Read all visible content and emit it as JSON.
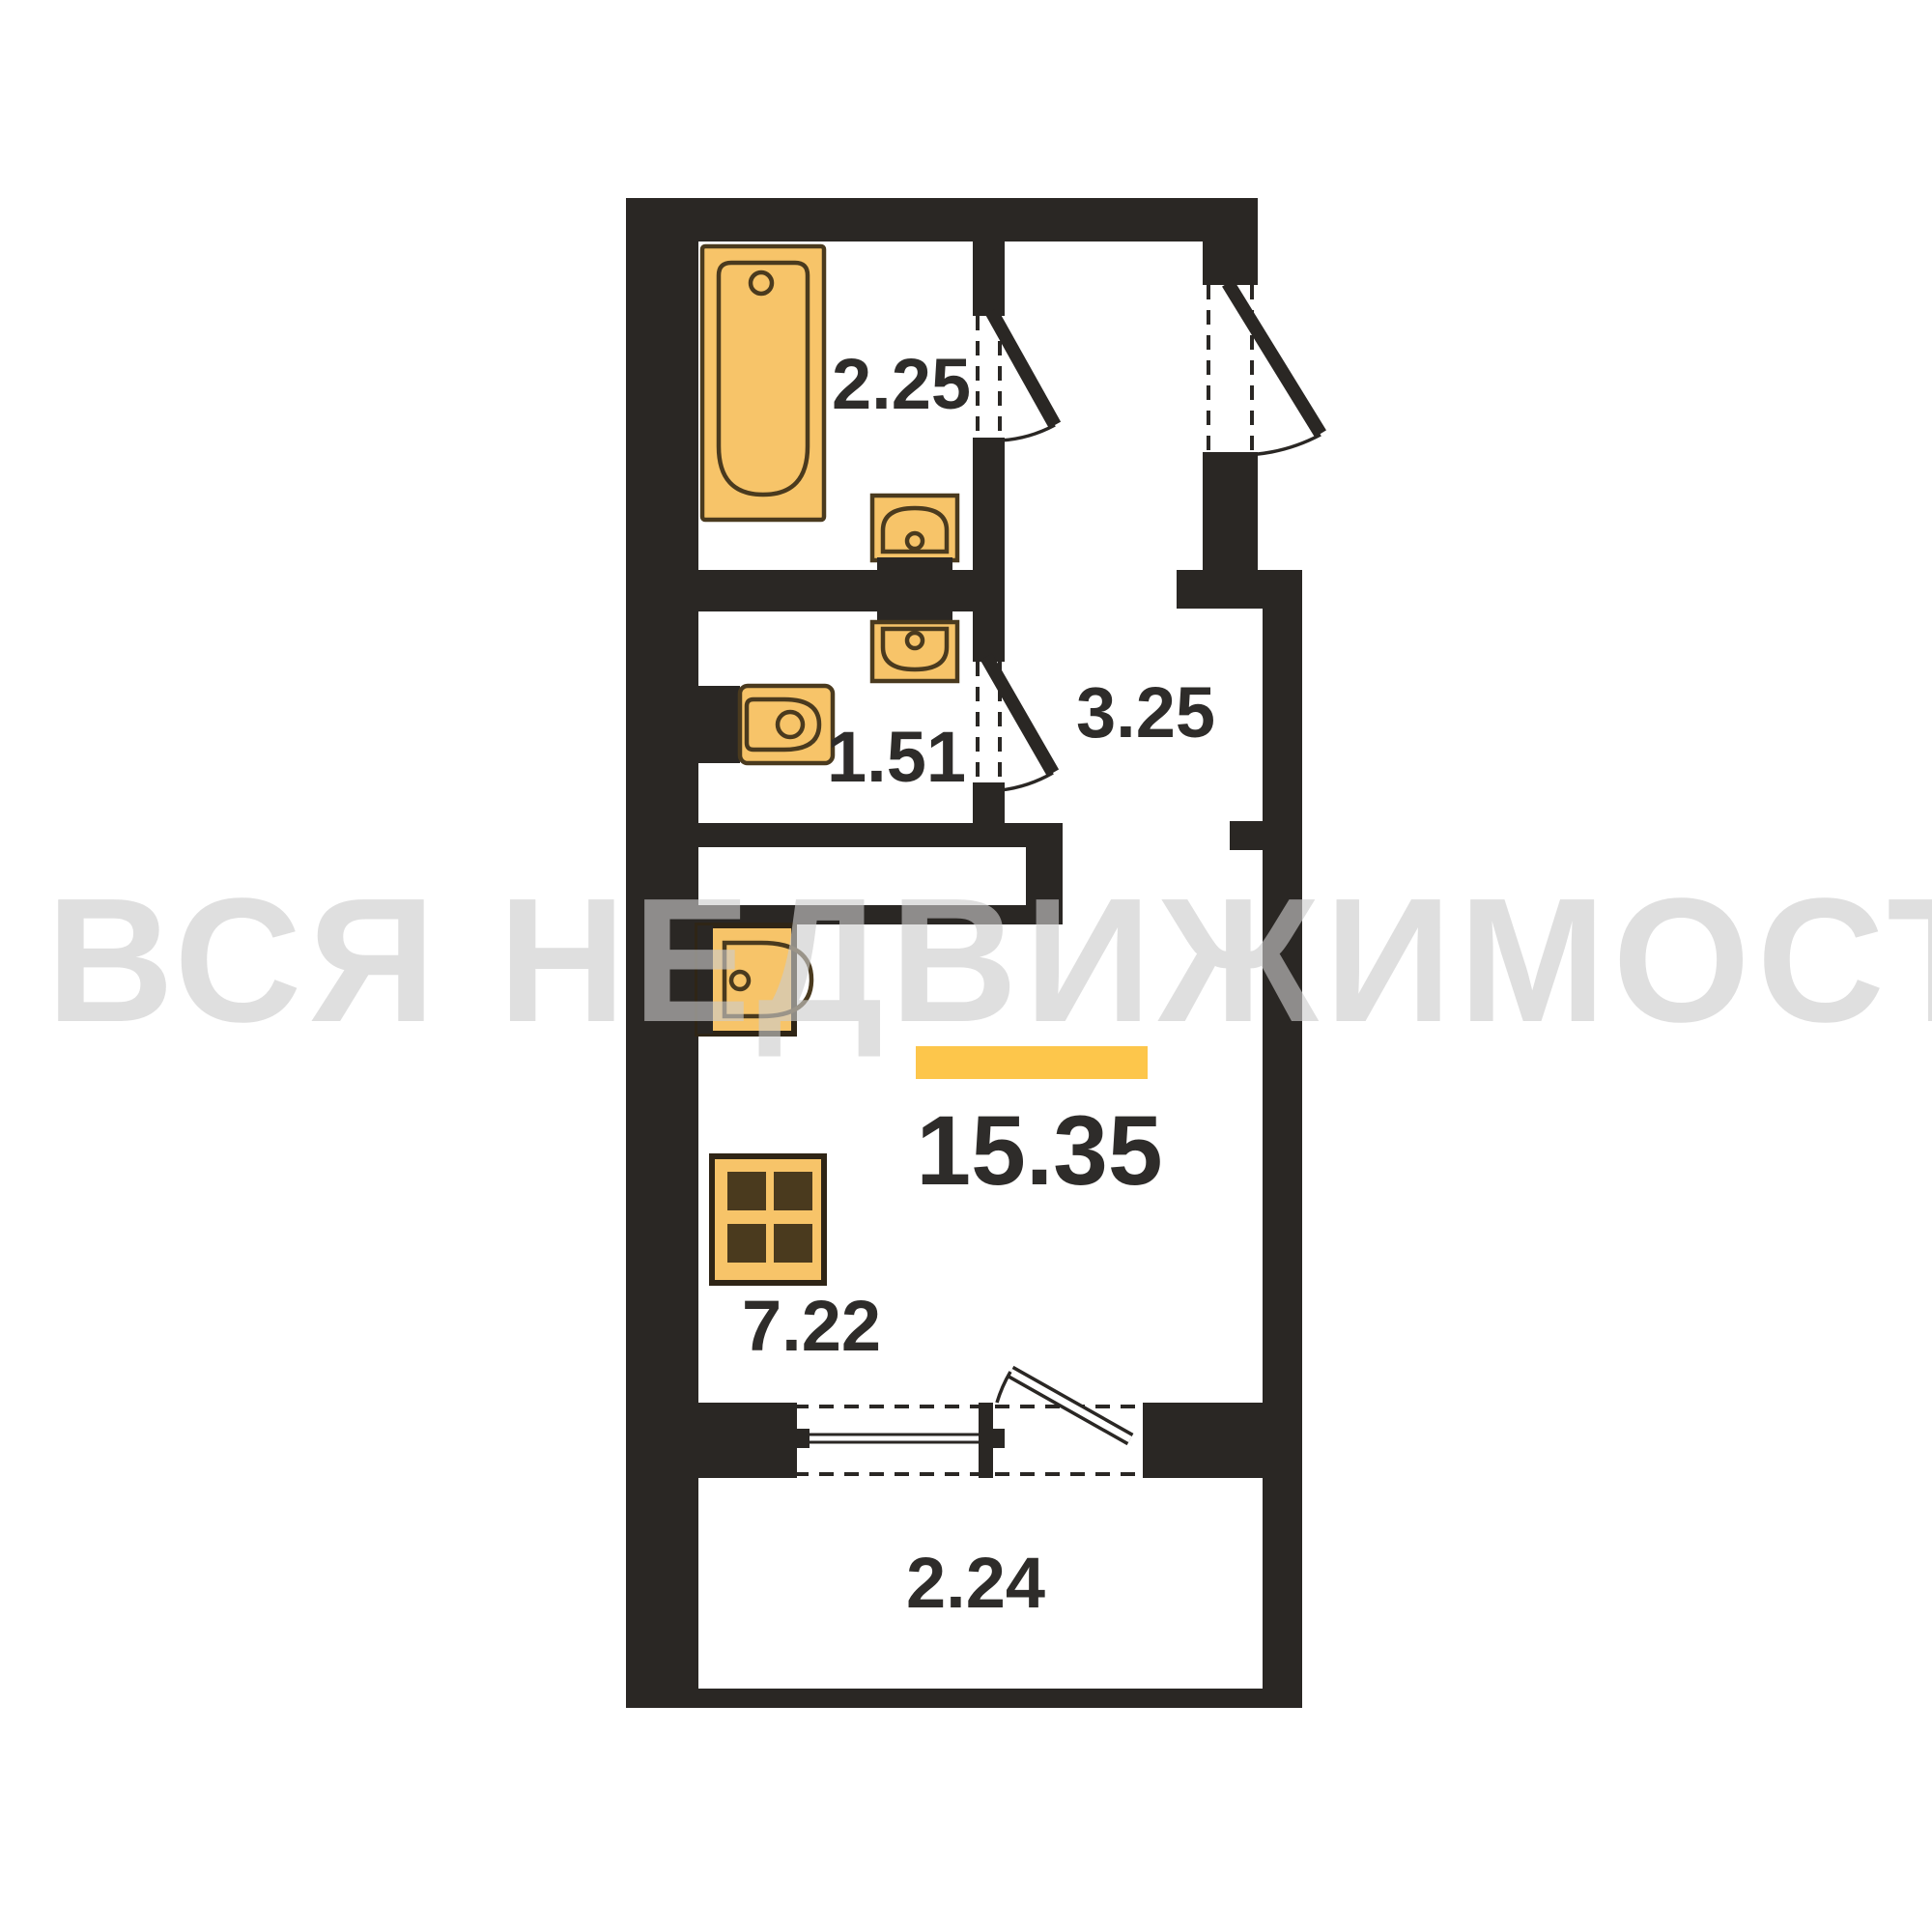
{
  "watermark": {
    "text": "ВСЯ НЕДВИЖИМОСТЬ"
  },
  "plan": {
    "title": "studio apartment floor plan",
    "rooms": [
      {
        "id": "bathroom",
        "area_label": "2.25"
      },
      {
        "id": "toilet",
        "area_label": "1.51"
      },
      {
        "id": "hallway",
        "area_label": "3.25"
      },
      {
        "id": "living-room",
        "area_label": "15.35"
      },
      {
        "id": "kitchen-zone",
        "area_label": "7.22"
      },
      {
        "id": "balcony",
        "area_label": "2.24"
      }
    ],
    "fixtures": [
      "bathtub",
      "bathroom-sink",
      "wc-sink",
      "toilet-bowl",
      "kitchen-sink",
      "stove",
      "wardrobe-highlight"
    ],
    "openings": [
      "bathroom-door",
      "wc-door",
      "entrance-door",
      "balcony-door",
      "balcony-window"
    ],
    "colors": {
      "wall": "#2a2724",
      "fixture": "#f7c469",
      "fixture2": "#f9cf82",
      "fixture_stroke": "#4a3a1e",
      "fixture_frame": "#2f2516",
      "highlight": "#fdc64b",
      "label": "#2e2c2a",
      "watermark": "rgba(203,203,203,0.62)"
    }
  }
}
